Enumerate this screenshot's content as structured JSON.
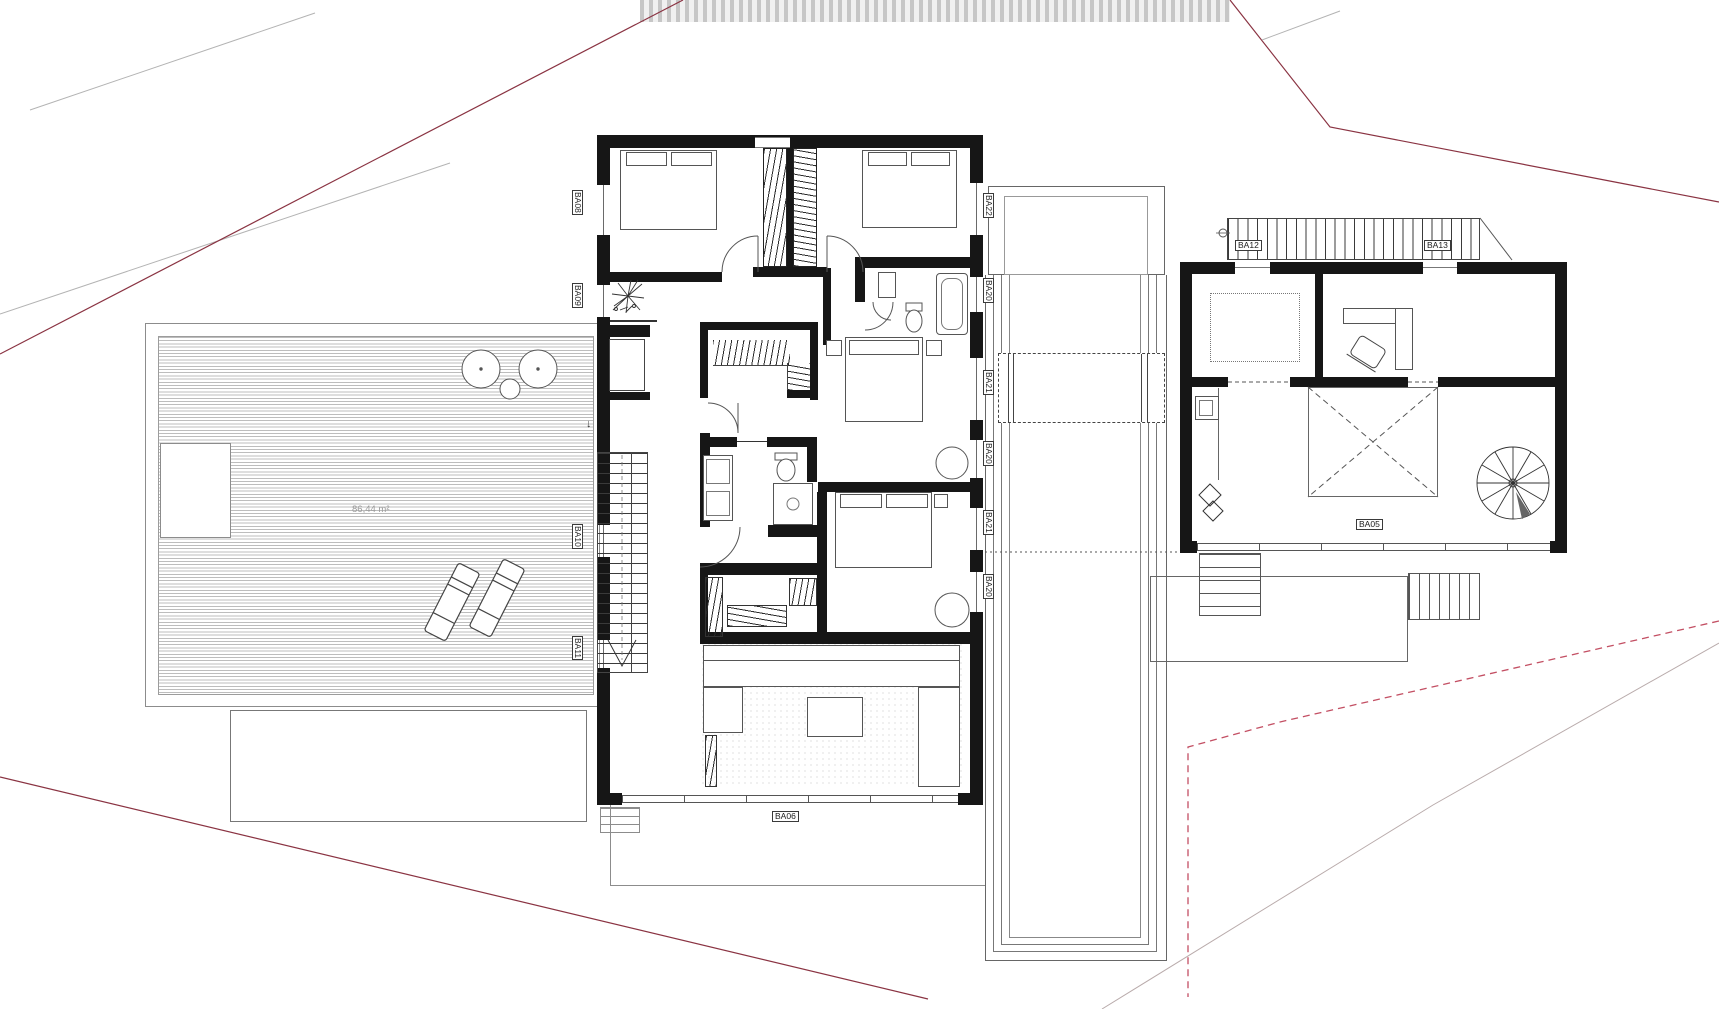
{
  "title": "floor-plan",
  "deck": {
    "area_label": "86,44 m²",
    "entry_arrow": "↓"
  },
  "labels": {
    "left": [
      {
        "id": "BA08"
      },
      {
        "id": "BA09"
      },
      {
        "id": "BA10"
      },
      {
        "id": "BA11"
      }
    ],
    "right": [
      {
        "id": "BA22"
      },
      {
        "id": "BA20"
      },
      {
        "id": "BA21"
      },
      {
        "id": "BA20"
      },
      {
        "id": "BA21"
      },
      {
        "id": "BA20"
      }
    ],
    "bottom": {
      "id": "BA06"
    },
    "annex_ramp": [
      {
        "id": "BA12"
      },
      {
        "id": "BA13"
      }
    ],
    "annex_room": {
      "id": "BA05"
    }
  },
  "colors": {
    "wall": "#161616",
    "boundary_red": "#8a3342",
    "boundary_red_dashed": "#c34f63",
    "boundary_gray": "#b3aaaa",
    "drawing_line": "#555555",
    "deck_line": "#bdbdbd"
  }
}
